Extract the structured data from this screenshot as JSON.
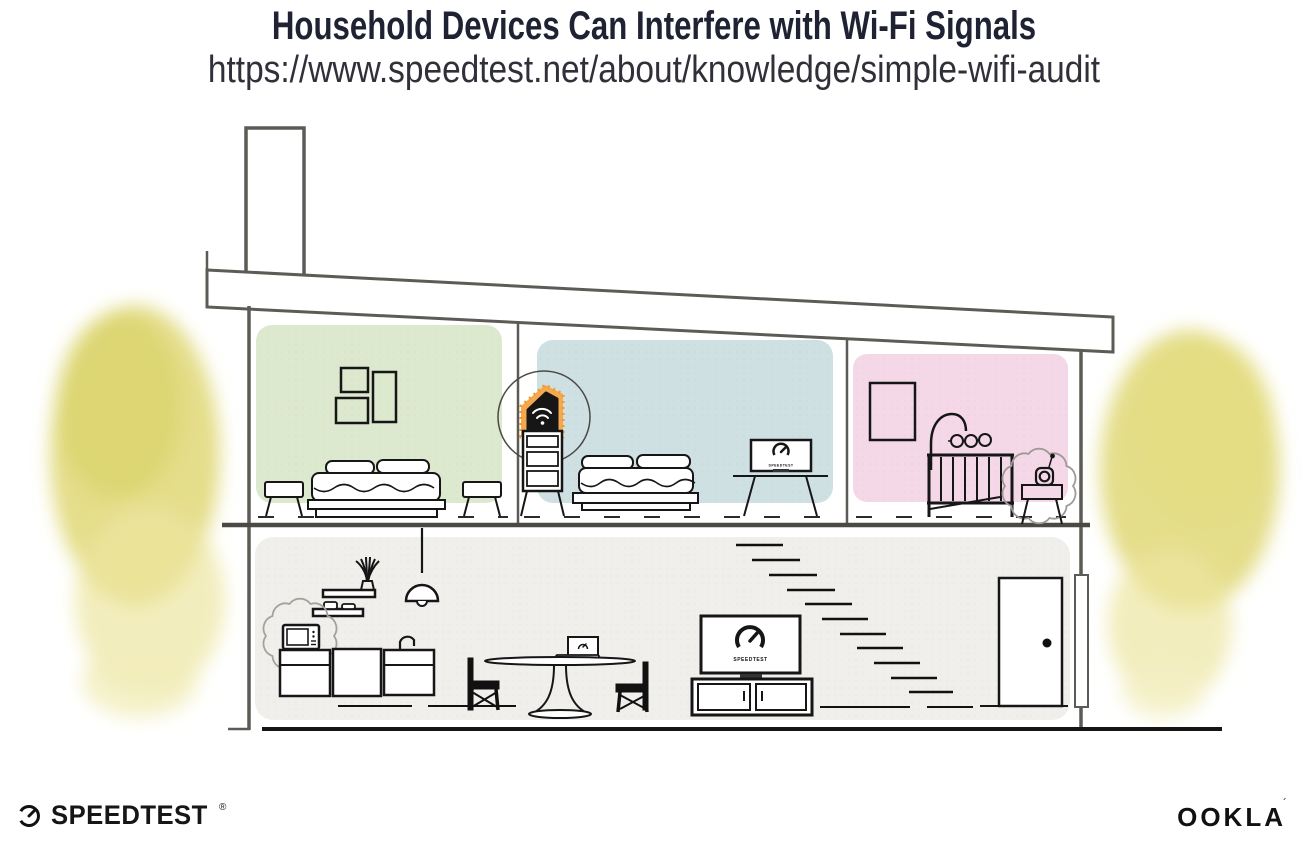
{
  "header": {
    "title": "Household Devices Can Interfere with Wi-Fi Signals",
    "url": "https://www.speedtest.net/about/knowledge/simple-wifi-audit"
  },
  "branding": {
    "speedtest_wordmark": "SPEEDTEST",
    "speedtest_trademark": "®",
    "ookla_wordmark": "OOKLA",
    "ookla_trademark": "´"
  },
  "illustration": {
    "scene": "Cutaway side view of a two-story house; a Wi-Fi router is highlighted in orange while a microwave and a baby monitor emit interference squiggles",
    "screen_brand_label": "SPEEDTEST",
    "rooms": [
      {
        "name": "bedroom-left",
        "wall_color": "#dde9cf",
        "items": "three wall frames, double bed, two stools"
      },
      {
        "name": "bedroom-middle",
        "wall_color": "#cfe0e3",
        "items": "double bed, TV with Speedtest gauge on stand, Wi-Fi router on shelf unit"
      },
      {
        "name": "nursery-right",
        "wall_color": "#f4d8e8",
        "items": "wall frame, baby mobile, crib, baby monitor on side table"
      },
      {
        "name": "downstairs-living-kitchen",
        "wall_color": "#f0efec",
        "items": "wall shelves with plant and bowls, pendant lamp, microwave, kitchen cabinets with faucet, dining table with laptop, two chairs, TV on media console, staircase, door"
      }
    ],
    "highlighted_devices": [
      {
        "name": "wifi-router",
        "highlight": "orange glow with spotlight circle",
        "accent_color": "#f5a94e"
      },
      {
        "name": "microwave",
        "highlight": "interference squiggle"
      },
      {
        "name": "baby-monitor",
        "highlight": "interference squiggle"
      }
    ],
    "colors": {
      "structure_line": "#5c5b55",
      "furniture_line": "#161616",
      "foliage_watercolor": "#ddd46a",
      "router_accent": "#f5a94e",
      "title_text": "#1f2233"
    }
  }
}
